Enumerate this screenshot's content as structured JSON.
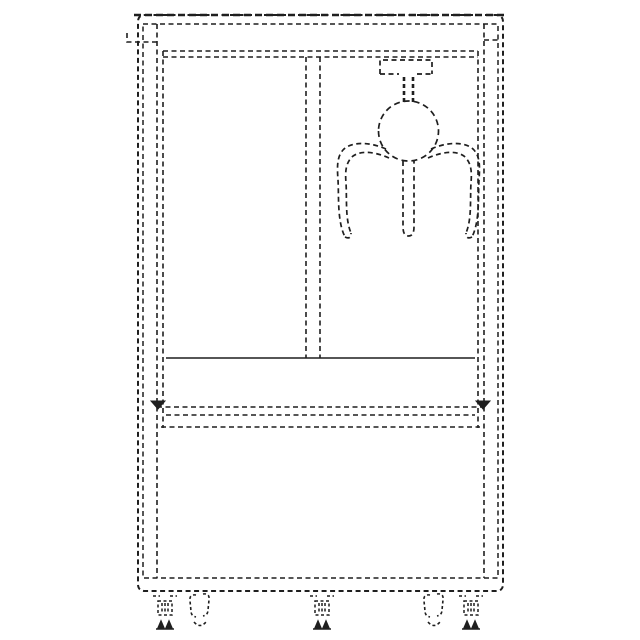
{
  "figure": {
    "title": "claw-machine-cabinet-line-drawing",
    "description": "Dashed technical outline drawing of an arcade claw (crane) machine cabinet, front view: top marquee cap, two glass window panes split by a center mullion, gantry carriage with hanging shaft, round claw head with three gripper arms, prize shelf band, lower base cabinet, and five feet (three leveling feet, two swivel casters).",
    "style": {
      "background": "#ffffff",
      "stroke_color": "#1f1f1f",
      "dash_pattern": "5 3.5",
      "stroke_width": 1.6
    },
    "components": [
      "cabinet-outer-shell",
      "top-marquee",
      "left-window-pane",
      "right-window-pane",
      "center-mullion",
      "gantry-carriage",
      "claw-shaft",
      "claw-head",
      "claw-arms",
      "prize-shelf",
      "base-cabinet",
      "leveling-feet",
      "caster-wheels"
    ],
    "segments": [
      {
        "name": "cabinet-outer-shell",
        "d": "M145,15 H496 Q503,15 503,22 V584 Q503,591 496,591 H145 Q138,591 138,584 V22 Q138,15 145,15 Z",
        "w": 2
      },
      {
        "name": "cabinet-top-edge-bold",
        "d": "M134,15 H507",
        "w": 2.6,
        "dash": "7 4"
      },
      {
        "name": "cabinet-inner-shell",
        "d": "M143,24 H498 V578 H143 Z",
        "w": 1.5
      },
      {
        "name": "door-frame-left-outer",
        "d": "M157,24 V578"
      },
      {
        "name": "door-frame-left-inner",
        "d": "M163,51 V428"
      },
      {
        "name": "door-frame-right-outer",
        "d": "M484,24 V578"
      },
      {
        "name": "door-frame-right-inner",
        "d": "M478,51 V428"
      },
      {
        "name": "hinge-tab-left",
        "d": "M127,33 V42 H157"
      },
      {
        "name": "hinge-tab-right",
        "d": "M484,40 H498"
      },
      {
        "name": "marquee-bottom-upper",
        "d": "M163,51 H478"
      },
      {
        "name": "marquee-bottom-lower",
        "d": "M163,57 H478"
      },
      {
        "name": "window-mullion-left-edge",
        "d": "M306,57 V358"
      },
      {
        "name": "window-mullion-right-edge",
        "d": "M320,57 V358"
      },
      {
        "name": "prize-shelf-edge",
        "d": "M166,358 H475",
        "dash": "none",
        "w": 1.5
      },
      {
        "name": "shelf-band-top",
        "d": "M157,407 H484"
      },
      {
        "name": "shelf-band-middle",
        "d": "M166,415 H475"
      },
      {
        "name": "shelf-band-bottom",
        "d": "M161,427 H480"
      },
      {
        "name": "shelf-corner-left",
        "d": "M151,401 L165,401 L158,409 Z",
        "fill": true,
        "dash": "none",
        "w": 1
      },
      {
        "name": "shelf-corner-right",
        "d": "M476,401 L490,401 L483,409 Z",
        "fill": true,
        "dash": "none",
        "w": 1
      },
      {
        "name": "gantry-carriage",
        "d": "M380,74 V60 H432 V74 M380,74 H399 M417,74 H432",
        "w": 1.7
      },
      {
        "name": "claw-shaft-left",
        "d": "M404,77 V102",
        "w": 2.6,
        "dash": "4 3"
      },
      {
        "name": "claw-shaft-right",
        "d": "M413,77 V102",
        "w": 2.6,
        "dash": "4 3"
      },
      {
        "name": "claw-head",
        "d": "M378.5,131 A30,30 0 1 0 438.5,131 A30,30 0 1 0 378.5,131 Z",
        "w": 1.7,
        "dash": "6 4"
      },
      {
        "name": "claw-arm-center",
        "d": "M403,161 V227 Q403,236 408.5,236 Q414,236 414,227 V161",
        "w": 1.7
      },
      {
        "name": "claw-arm-left-outer",
        "d": "M386,149 C368,141 350,142 343,150 C337,157 337,166 338,180 C339,196 337,221 345,237",
        "w": 1.7
      },
      {
        "name": "claw-arm-left-inner",
        "d": "M389,158 C371,150 357,151 351,158 C346,164 345,171 346,183 C347,198 345,219 351,233",
        "w": 1.7
      },
      {
        "name": "claw-arm-left-tip",
        "d": "M345,237 Q351,240 351,233",
        "w": 1.7
      },
      {
        "name": "claw-arm-right-outer",
        "d": "M431,149 C449,141 467,142 474,150 C480,157 480,166 479,180 C478,196 480,221 472,237",
        "w": 1.7
      },
      {
        "name": "claw-arm-right-inner",
        "d": "M428,158 C446,150 460,151 466,158 C471,164 472,171 471,183 C470,198 472,219 466,233",
        "w": 1.7
      },
      {
        "name": "claw-arm-right-tip",
        "d": "M472,237 Q466,240 466,233",
        "w": 1.7
      },
      {
        "name": "leveler-foot-left-mount",
        "d": "M153,596 H160 M170,596 H177",
        "dash": "3 2.5"
      },
      {
        "name": "leveler-foot-left-body",
        "d": "M158,601 H172 V615 H158 Z M162,603 V613 M165,603 V613 M168,603 V613",
        "dash": "3 2.5",
        "w": 1.5
      },
      {
        "name": "leveler-foot-left-base",
        "d": "M158,628 L161,621 L164,628 Z M166,628 L169,621 L172,628 Z M156,629 H174",
        "fill": true,
        "dash": "none",
        "w": 1.4
      },
      {
        "name": "caster-foot-left",
        "d": "M196,595 Q189,594 190,601 L191,611 Q191,616 196,617 M203,594 Q210,593 209,600 L208,610 Q208,615 203,616 M194,622 Q200,629 206,622",
        "dash": "3 2.5",
        "w": 1.6
      },
      {
        "name": "leveler-foot-center-mount",
        "d": "M310,596 H317 M327,596 H334",
        "dash": "3 2.5"
      },
      {
        "name": "leveler-foot-center-body",
        "d": "M315,601 H329 V615 H315 Z M319,603 V613 M322,603 V613 M325,603 V613",
        "dash": "3 2.5",
        "w": 1.5
      },
      {
        "name": "leveler-foot-center-base",
        "d": "M315,628 L318,621 L321,628 Z M323,628 L326,621 L329,628 Z M313,629 H331",
        "fill": true,
        "dash": "none",
        "w": 1.4
      },
      {
        "name": "caster-foot-right",
        "d": "M430,595 Q423,594 424,601 L425,611 Q425,616 430,617 M437,594 Q444,593 443,600 L442,610 Q442,615 437,616 M428,622 Q434,629 440,622",
        "dash": "3 2.5",
        "w": 1.6
      },
      {
        "name": "leveler-foot-right-mount",
        "d": "M459,596 H466 M476,596 H483",
        "dash": "3 2.5"
      },
      {
        "name": "leveler-foot-right-body",
        "d": "M464,601 H478 V615 H464 Z M468,603 V613 M471,603 V613 M474,603 V613",
        "dash": "3 2.5",
        "w": 1.5
      },
      {
        "name": "leveler-foot-right-base",
        "d": "M464,628 L467,621 L470,628 Z M472,628 L475,621 L478,628 Z M462,629 H480",
        "fill": true,
        "dash": "none",
        "w": 1.4
      }
    ]
  }
}
